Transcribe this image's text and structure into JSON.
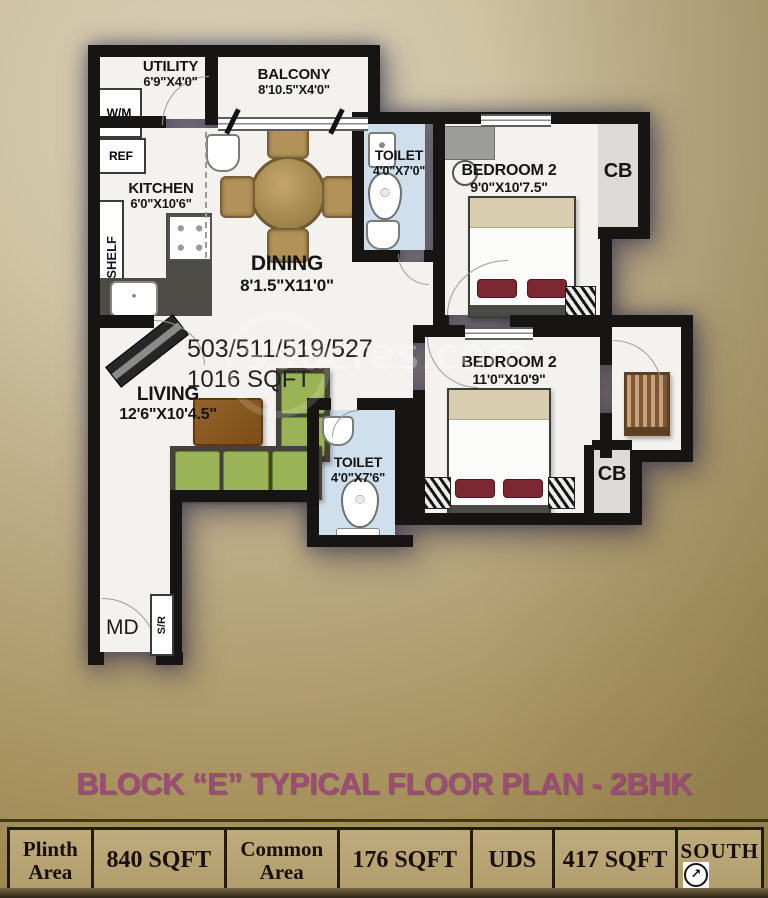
{
  "watermark": {
    "text": "99acres.com"
  },
  "plan": {
    "unit_numbers": "503/511/519/527",
    "unit_area": "1016 SQFT",
    "rooms": {
      "utility": {
        "name": "UTILITY",
        "dim": "6'9\"X4'0\""
      },
      "balcony": {
        "name": "BALCONY",
        "dim": "8'10.5\"X4'0\""
      },
      "kitchen": {
        "name": "KITCHEN",
        "dim": "6'0\"X10'6\""
      },
      "dining": {
        "name": "DINING",
        "dim": "8'1.5\"X11'0\""
      },
      "toilet_top": {
        "name": "TOILET",
        "dim": "4'0\"X7'0\""
      },
      "bedroom_top": {
        "name": "BEDROOM 2",
        "dim": "9'0\"X10'7.5\""
      },
      "living": {
        "name": "LIVING",
        "dim": "12'6\"X10'4.5\""
      },
      "toilet_bottom": {
        "name": "TOILET",
        "dim": "4'0\"X7'6\""
      },
      "bedroom_bottom": {
        "name": "BEDROOM 2",
        "dim": "11'0\"X10'9\""
      }
    },
    "tags": {
      "washing_machine": "W/M",
      "refrigerator": "REF",
      "shelf": "SHELF",
      "shoe_rack": "S/R",
      "main_door": "MD",
      "cupboard_top": "CB",
      "cupboard_bottom": "CB"
    }
  },
  "footer": {
    "title": "BLOCK “E” TYPICAL FLOOR PLAN - 2BHK",
    "table": [
      {
        "label": "Plinth Area"
      },
      {
        "label": "840 SQFT"
      },
      {
        "label": "Common Area"
      },
      {
        "label": "176 SQFT"
      },
      {
        "label": "UDS"
      },
      {
        "label": "417 SQFT"
      }
    ],
    "south": {
      "label": "SOUTH",
      "arrow": "↗"
    }
  },
  "colors": {
    "wall": "#171513",
    "toilet_floor": "#cfe0ec",
    "sofa_green": "#9ab357",
    "title_accent": "#9d4b78",
    "background_tan": "#bcab84"
  }
}
